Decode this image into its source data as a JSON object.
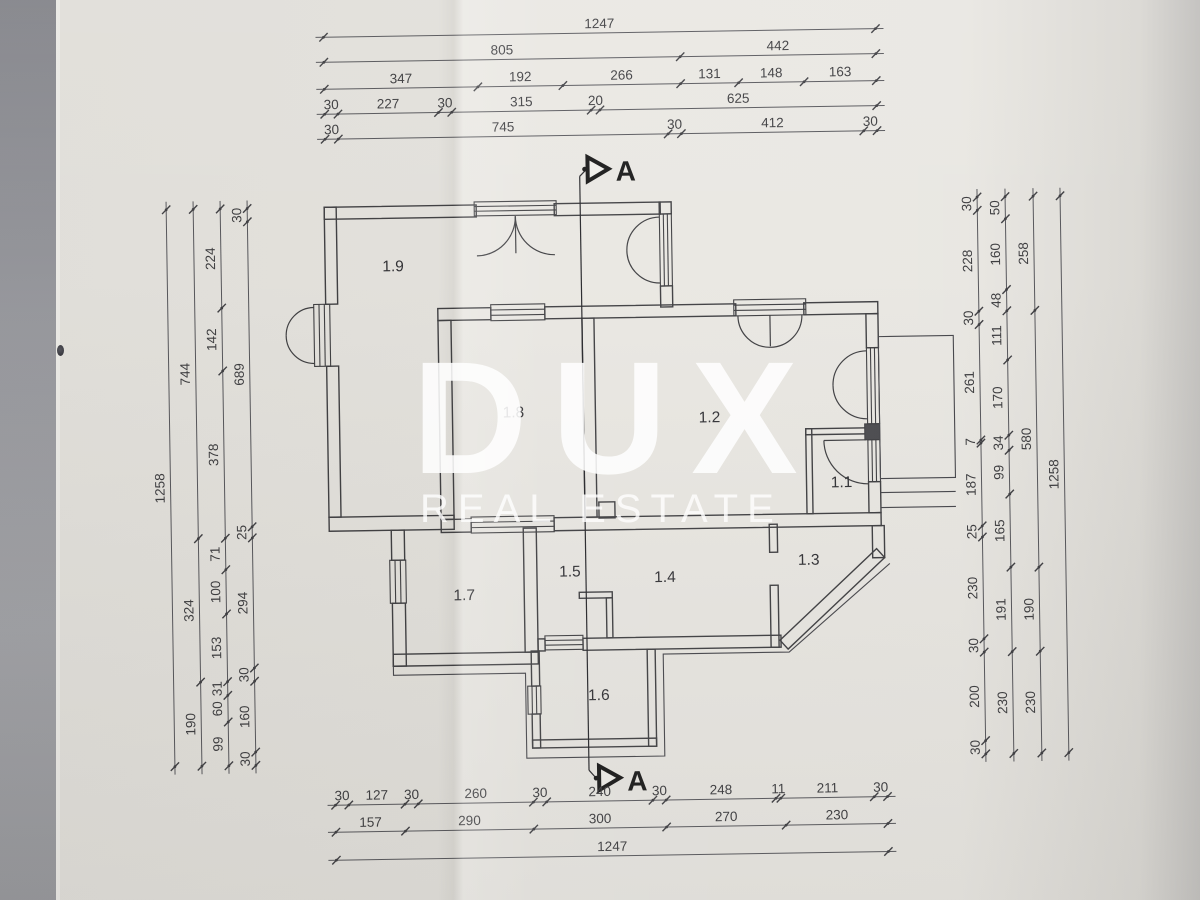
{
  "watermark": {
    "brand": "DUX",
    "tagline": "REAL ESTATE"
  },
  "section": {
    "label": "A"
  },
  "rooms": [
    {
      "label": "1.9",
      "x": 396,
      "y": 268
    },
    {
      "label": "1.8",
      "x": 514,
      "y": 416
    },
    {
      "label": "1.2",
      "x": 710,
      "y": 424
    },
    {
      "label": "1.1",
      "x": 841,
      "y": 491
    },
    {
      "label": "1.7",
      "x": 462,
      "y": 598
    },
    {
      "label": "1.5",
      "x": 568,
      "y": 576
    },
    {
      "label": "1.4",
      "x": 663,
      "y": 583
    },
    {
      "label": "1.3",
      "x": 807,
      "y": 568
    },
    {
      "label": "1.6",
      "x": 595,
      "y": 700
    }
  ],
  "scale_px_per_cm": 0.4427,
  "dims": {
    "top": [
      {
        "pos": 33,
        "start": 330,
        "segments": [
          1247
        ]
      },
      {
        "pos": 58,
        "start": 330,
        "segments": [
          805,
          442
        ]
      },
      {
        "pos": 85,
        "start": 330,
        "segments": [
          347,
          192,
          266,
          131,
          148,
          163
        ]
      },
      {
        "pos": 110,
        "start": 330,
        "segments": [
          30,
          227,
          30,
          315,
          20,
          625
        ]
      },
      {
        "pos": 135,
        "start": 330,
        "segments": [
          30,
          745,
          30,
          412,
          30
        ]
      }
    ],
    "bottom": [
      {
        "pos": 801,
        "start": 330,
        "segments": [
          30,
          127,
          30,
          260,
          30,
          240,
          30,
          248,
          11,
          211,
          30
        ]
      },
      {
        "pos": 828,
        "start": 330,
        "segments": [
          157,
          290,
          300,
          270,
          230
        ]
      },
      {
        "pos": 856,
        "start": 330,
        "segments": [
          1247
        ]
      }
    ],
    "left": [
      {
        "pos": 170,
        "start": 203,
        "segments": [
          1258
        ]
      },
      {
        "pos": 197,
        "start": 203,
        "segments": [
          744,
          324,
          190
        ]
      },
      {
        "pos": 224,
        "start": 203,
        "segments": [
          224,
          142,
          378,
          71,
          100,
          153,
          31,
          60,
          99
        ]
      },
      {
        "pos": 251,
        "start": 203,
        "segments": [
          30,
          689,
          25,
          294,
          30,
          160,
          30
        ]
      }
    ],
    "right": [
      {
        "pos": 981,
        "start": 203,
        "segments": [
          30,
          228,
          30,
          261,
          7,
          187,
          25,
          230,
          30,
          200,
          30
        ]
      },
      {
        "pos": 1009,
        "start": 203,
        "segments": [
          50,
          160,
          48,
          111,
          170,
          34,
          99,
          165,
          191,
          230
        ]
      },
      {
        "pos": 1037,
        "start": 203,
        "segments": [
          258,
          580,
          190,
          230
        ]
      },
      {
        "pos": 1064,
        "start": 203,
        "segments": [
          1258
        ]
      }
    ]
  },
  "colors": {
    "paper": "#e9e7e2",
    "wall_line": "#3d3d40",
    "dim_line": "#55555a",
    "dim_text": "#3a3a3d",
    "watermark": "#ffffff"
  }
}
